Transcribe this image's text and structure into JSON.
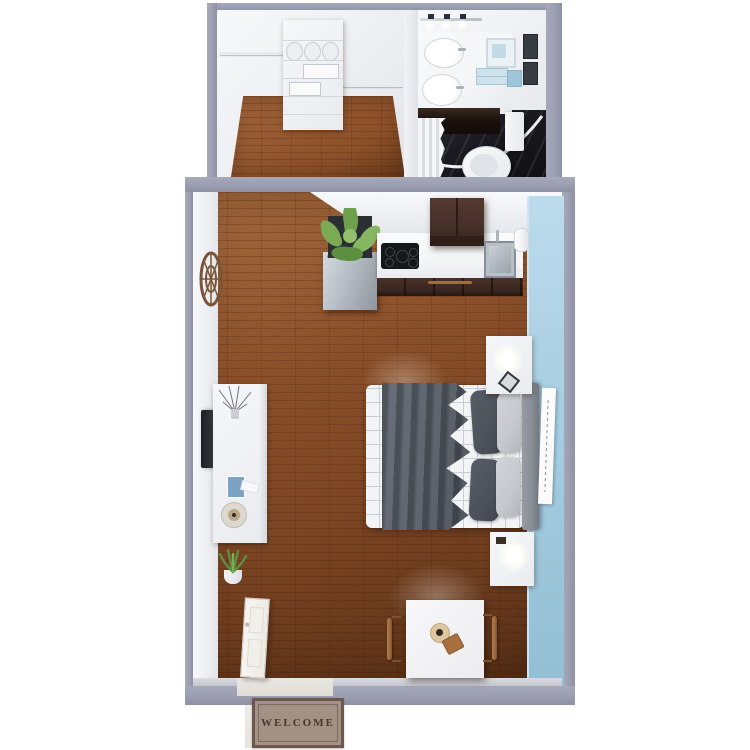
{
  "scene": {
    "type": "3d-floor-plan",
    "unit": "studio-apartment",
    "welcome_mat": {
      "text": "WELCOME"
    },
    "rooms": [
      {
        "name": "closet",
        "furniture": [
          "shelving-unit",
          "towel-rolls",
          "wire-baskets",
          "hanging-rods",
          "wood-floor"
        ]
      },
      {
        "name": "bathroom",
        "furniture": [
          "vanity-counter",
          "double-sink",
          "vanity-lights",
          "vanity-cabinet",
          "toilet",
          "shower-curtain",
          "curved-shower-rod",
          "towel-frame",
          "folded-towels",
          "tissue-box",
          "wall-frames",
          "dark-tile-floor"
        ]
      },
      {
        "name": "main-room",
        "furniture": [
          "refrigerator",
          "large-potted-plant",
          "cooktop",
          "upper-cabinets",
          "kitchen-sink",
          "paper-towel-roll",
          "lower-cabinets-oven",
          "bed",
          "headboard",
          "blanket",
          "pillows",
          "wall-art",
          "nightstand-top",
          "nightstand-bottom",
          "table-lamps",
          "wall-tv",
          "media-console",
          "branch-vase",
          "record-player",
          "magazines",
          "small-potted-plant",
          "wall-clock",
          "dining-table",
          "dining-chairs",
          "place-setting",
          "entry-door",
          "entry-stoop"
        ]
      }
    ]
  },
  "palette": {
    "bg": "#ffffff",
    "wall-gray": "#9b9eb0",
    "wall-white": "#eef0f3",
    "wood": "#8a4f2a",
    "wood-light": "#a0633a",
    "blue-wall": "#a9cfe2",
    "counter-white": "#f4f5f7",
    "cabinet-brown": "#46302a",
    "cabinet-dark": "#38261f",
    "bath-floor": "#1a1a20",
    "blanket-gray": "#565c65",
    "pillow-dark": "#4c525a",
    "pillow-light": "#c5c8cd",
    "headboard": "#8a8f97",
    "stainless": "#b9c0c7",
    "plant-green": "#6fa04c",
    "chair-wood": "#9a6a41",
    "mat-tan": "#a39183",
    "mat-border": "#6d5751",
    "mat-text": "#463831"
  }
}
